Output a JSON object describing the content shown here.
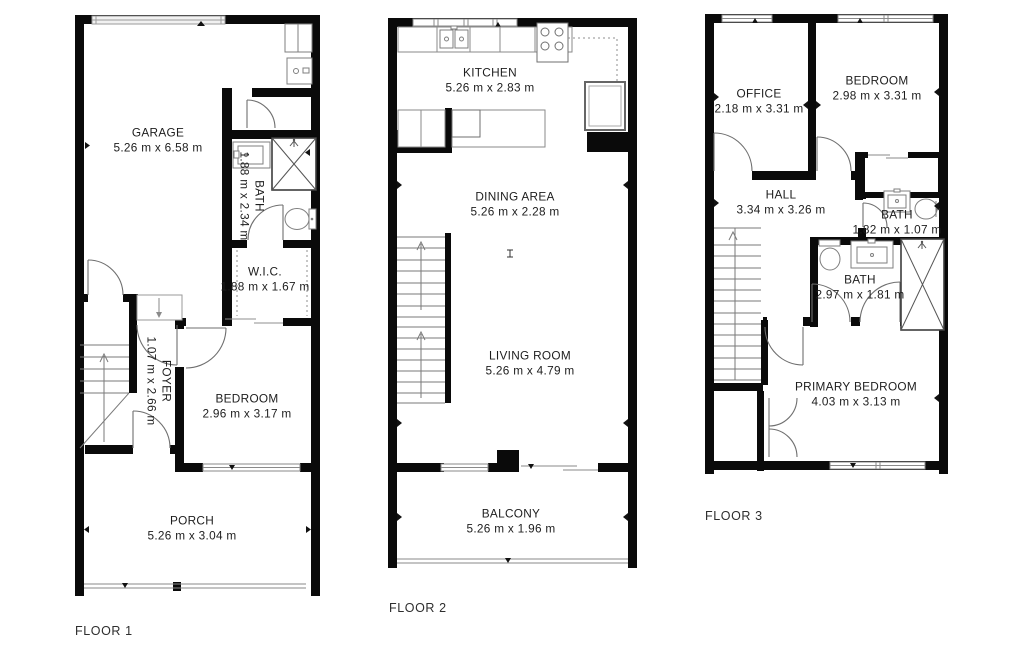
{
  "floors": [
    {
      "label": "FLOOR 1",
      "rooms": [
        {
          "id": "garage",
          "name": "GARAGE",
          "dims": "5.26 m x 6.58 m"
        },
        {
          "id": "bath",
          "name": "BATH",
          "dims": "1.88 m x 2.34 m"
        },
        {
          "id": "wic",
          "name": "W.I.C.",
          "dims": "1.88 m x 1.67 m"
        },
        {
          "id": "foyer",
          "name": "FOYER",
          "dims": "1.07 m x 2.66 m"
        },
        {
          "id": "bedroom",
          "name": "BEDROOM",
          "dims": "2.96 m x 3.17 m"
        },
        {
          "id": "porch",
          "name": "PORCH",
          "dims": "5.26 m x 3.04 m"
        }
      ]
    },
    {
      "label": "FLOOR 2",
      "rooms": [
        {
          "id": "kitchen",
          "name": "KITCHEN",
          "dims": "5.26 m x 2.83 m"
        },
        {
          "id": "dining-area",
          "name": "DINING AREA",
          "dims": "5.26 m x 2.28 m"
        },
        {
          "id": "living-room",
          "name": "LIVING ROOM",
          "dims": "5.26 m x 4.79 m"
        },
        {
          "id": "balcony",
          "name": "BALCONY",
          "dims": "5.26 m x 1.96 m"
        }
      ]
    },
    {
      "label": "FLOOR 3",
      "rooms": [
        {
          "id": "office",
          "name": "OFFICE",
          "dims": "2.18 m x 3.31 m"
        },
        {
          "id": "bedroom",
          "name": "BEDROOM",
          "dims": "2.98 m x 3.31 m"
        },
        {
          "id": "hall",
          "name": "HALL",
          "dims": "3.34 m x 3.26 m"
        },
        {
          "id": "bath-upper",
          "name": "BATH",
          "dims": "1.82 m x 1.07 m"
        },
        {
          "id": "bath-main",
          "name": "BATH",
          "dims": "2.97 m x 1.81 m"
        },
        {
          "id": "primary-bedroom",
          "name": "PRIMARY BEDROOM",
          "dims": "4.03 m x 3.13 m"
        }
      ]
    }
  ],
  "colors": {
    "wall": "#0a0a0a",
    "fixture_line": "#6f6f6f",
    "stair_line": "#7a7a7a",
    "window_outline": "#8a8a8a",
    "label_text": "#1d1d1d",
    "caption_text": "#2e2e2e"
  }
}
